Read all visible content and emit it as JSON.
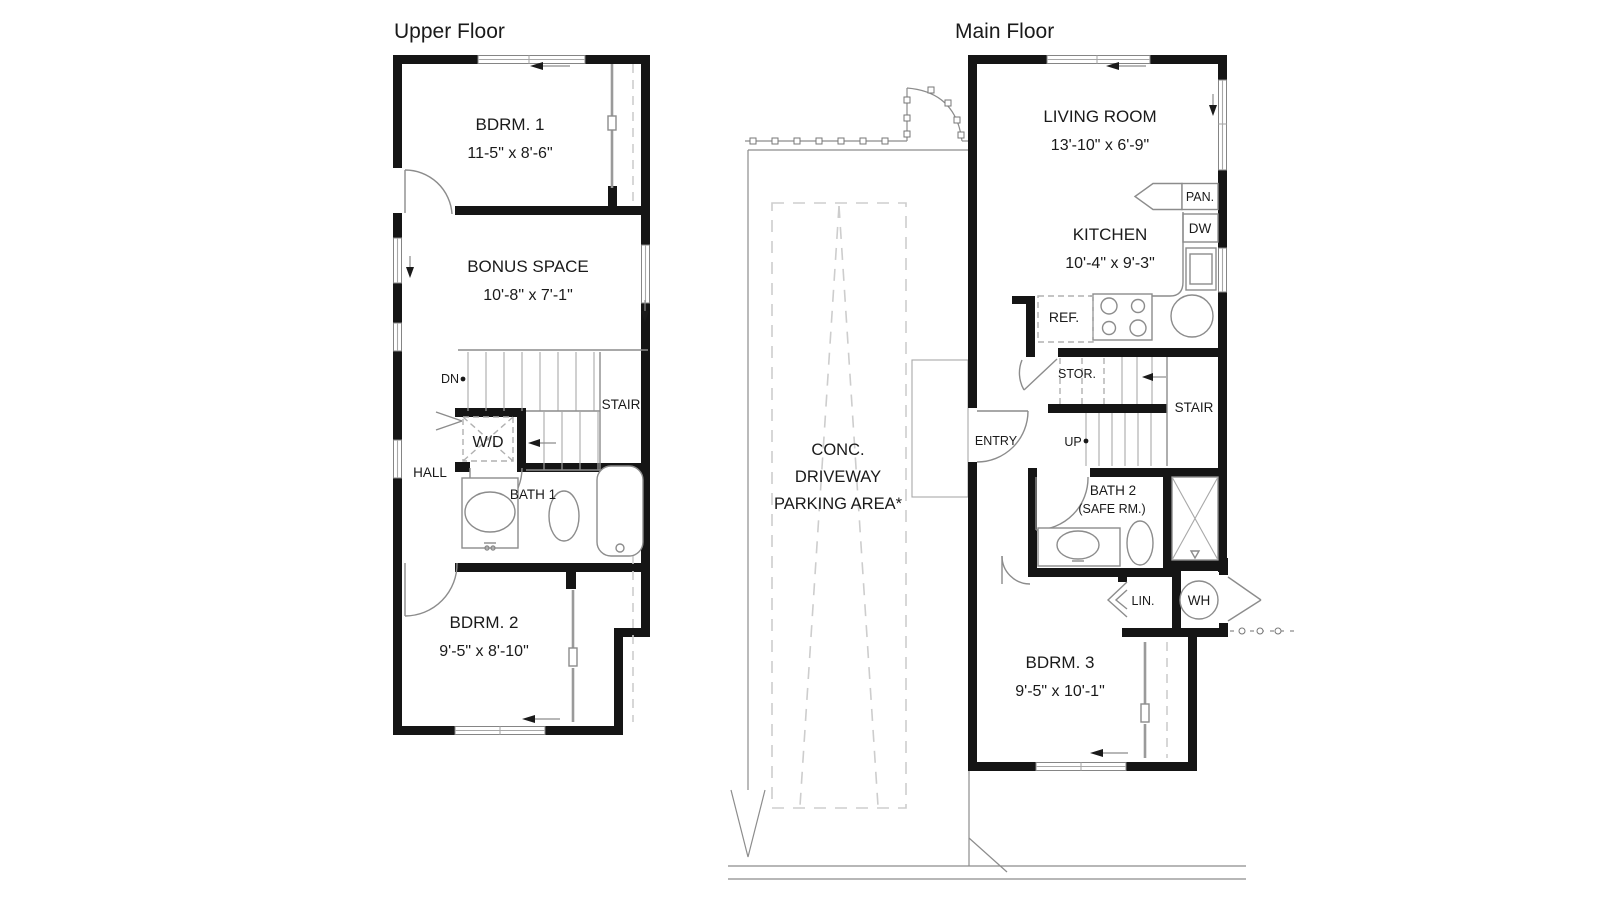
{
  "colors": {
    "wall": "#151515",
    "thin_line": "#8c8c8c",
    "hidden_dash": "#cdcdcd",
    "text": "#1a1a1a",
    "background": "#ffffff"
  },
  "upper_floor": {
    "title": "Upper Floor",
    "rooms": {
      "bdrm1": {
        "name": "BDRM. 1",
        "dims": "11-5\" x 8'-6\""
      },
      "bonus": {
        "name": "BONUS SPACE",
        "dims": "10'-8\" x 7'-1\""
      },
      "bdrm2": {
        "name": "BDRM. 2",
        "dims": "9'-5\" x 8'-10\""
      },
      "bath1": {
        "name": "BATH 1"
      },
      "hall": {
        "name": "HALL"
      },
      "stair": {
        "name": "STAIR"
      },
      "wd": {
        "name": "W/D"
      },
      "dn": {
        "name": "DN"
      }
    }
  },
  "main_floor": {
    "title": "Main Floor",
    "rooms": {
      "living": {
        "name": "LIVING ROOM",
        "dims": "13'-10\" x 6'-9\""
      },
      "kitchen": {
        "name": "KITCHEN",
        "dims": "10'-4\" x 9'-3\""
      },
      "bdrm3": {
        "name": "BDRM. 3",
        "dims": "9'-5\" x 10'-1\""
      },
      "bath2": {
        "name": "BATH 2",
        "sub": "(SAFE RM.)"
      },
      "pan": {
        "name": "PAN."
      },
      "dw": {
        "name": "DW"
      },
      "ref": {
        "name": "REF."
      },
      "stor": {
        "name": "STOR."
      },
      "stair": {
        "name": "STAIR"
      },
      "up": {
        "name": "UP"
      },
      "entry": {
        "name": "ENTRY"
      },
      "lin": {
        "name": "LIN."
      },
      "wh": {
        "name": "WH"
      }
    }
  },
  "site": {
    "driveway_line1": "CONC.",
    "driveway_line2": "DRIVEWAY",
    "driveway_line3": "PARKING AREA*"
  }
}
